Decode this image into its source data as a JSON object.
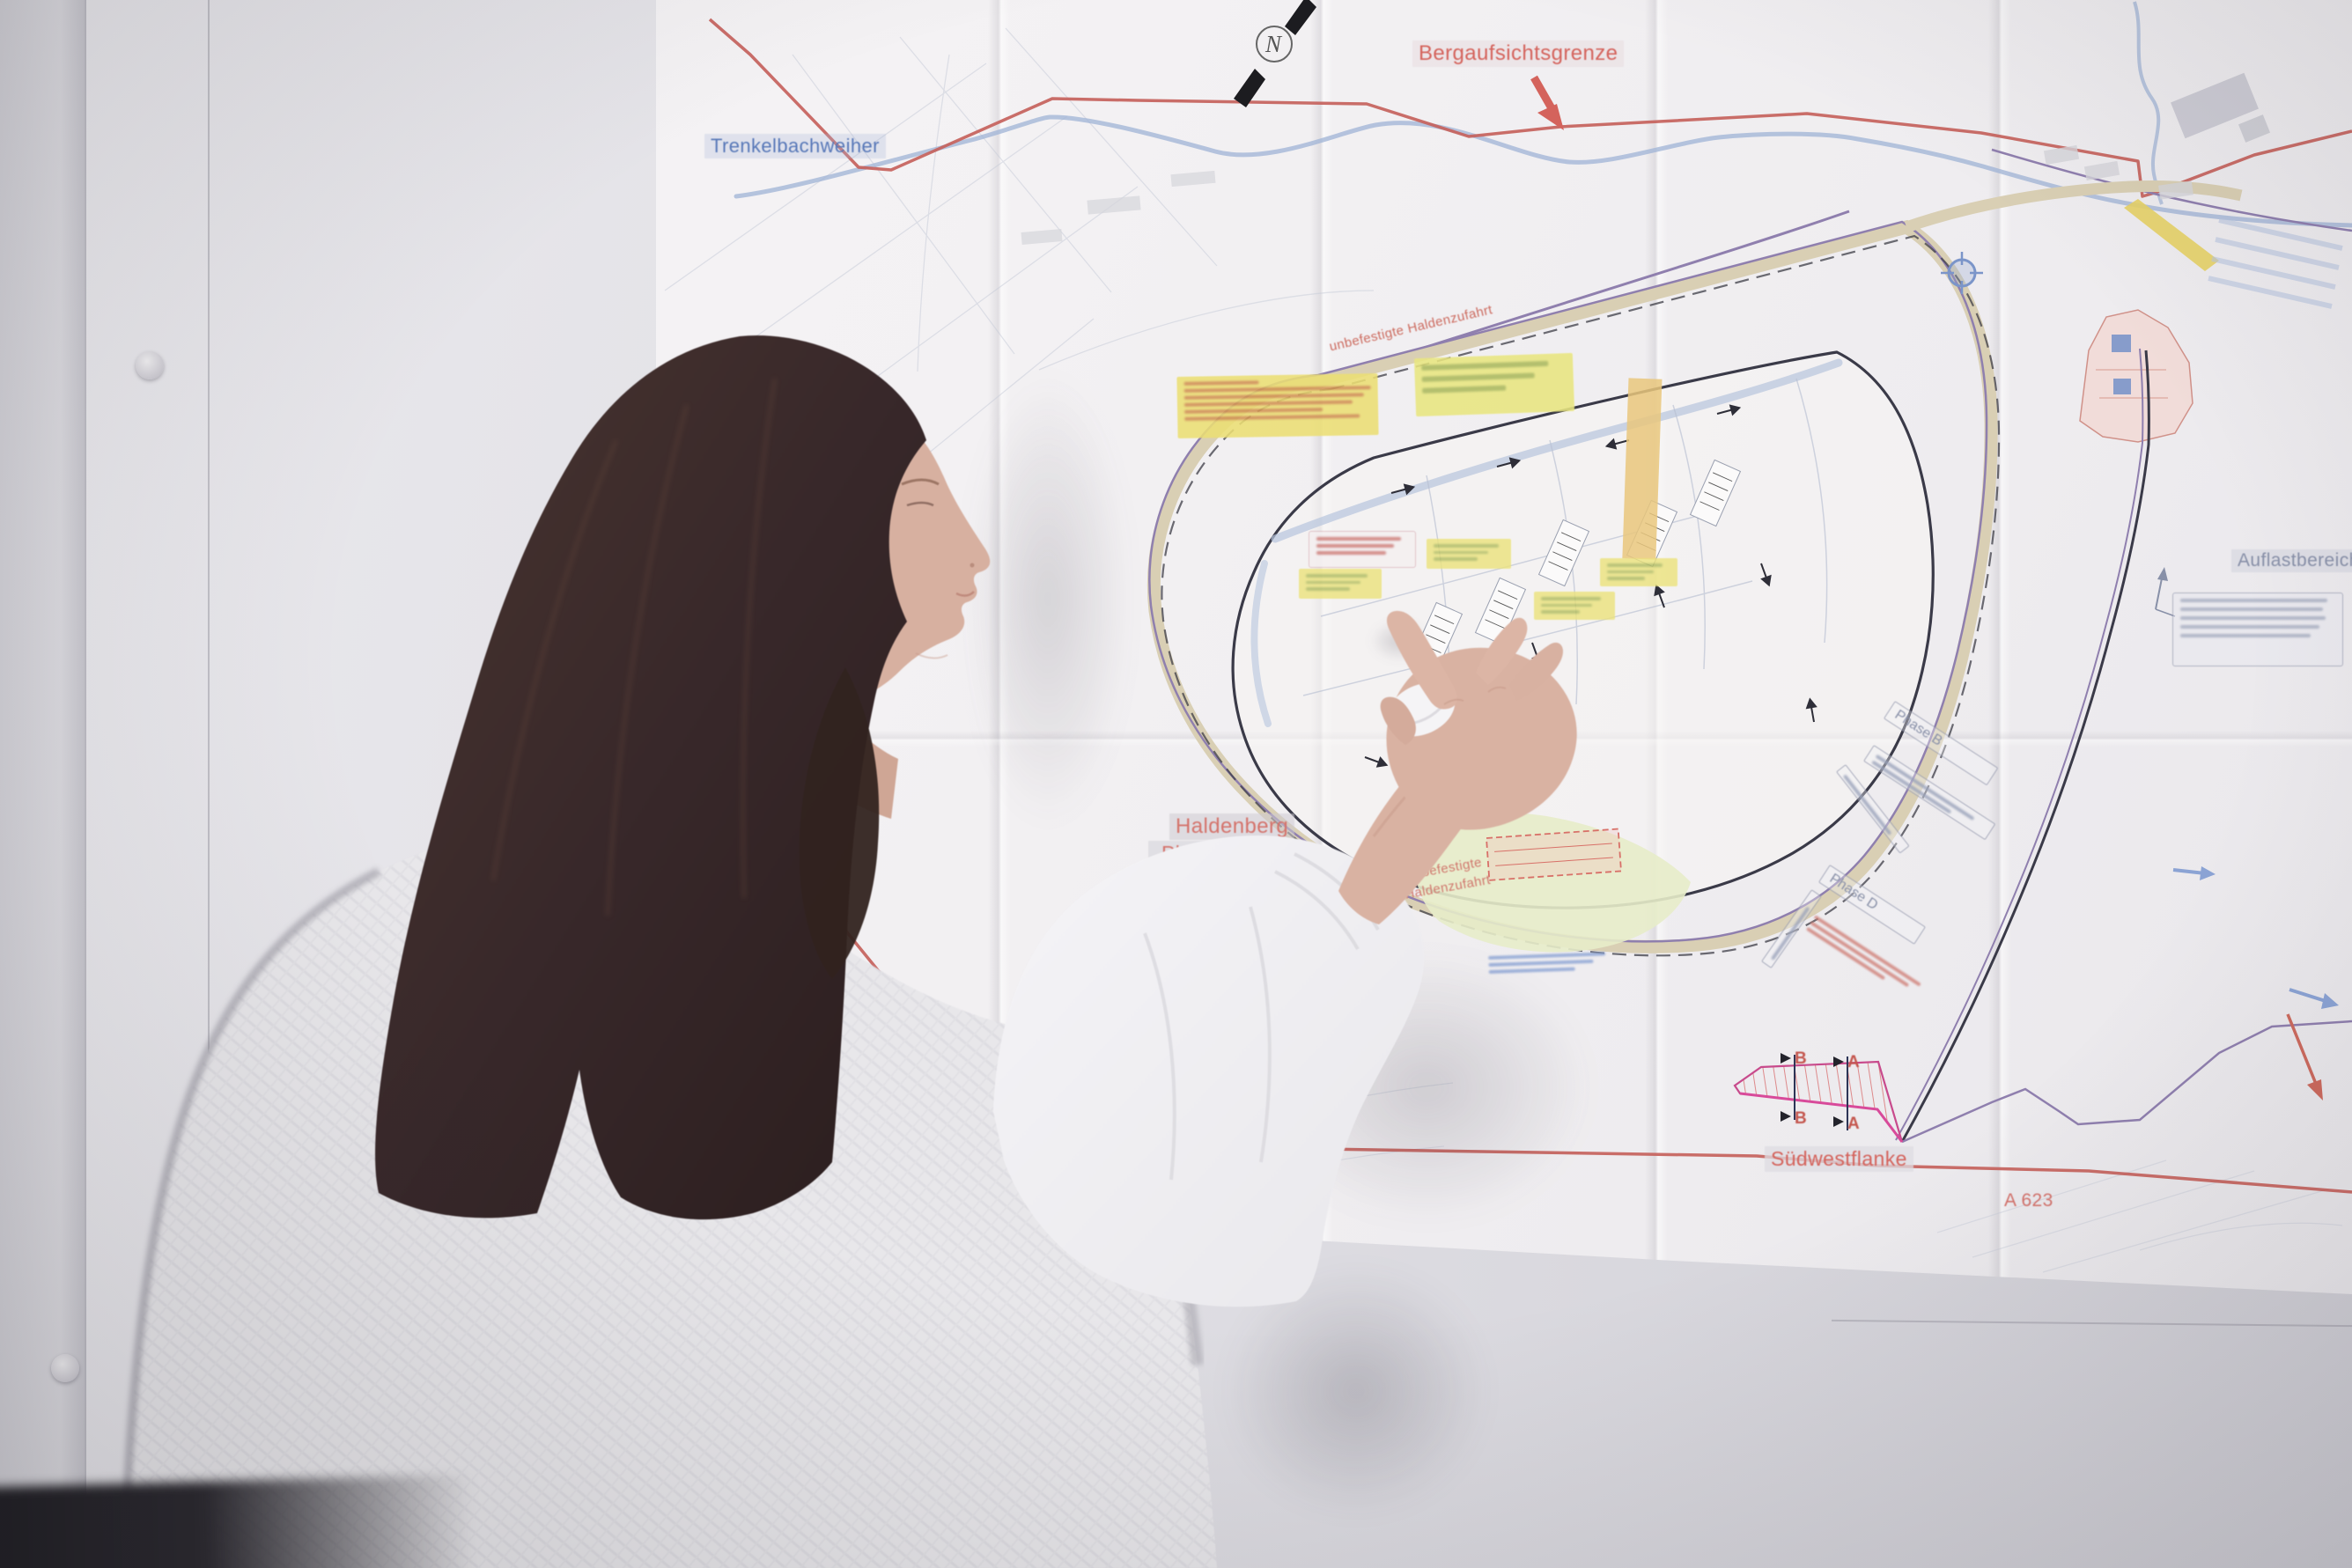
{
  "scene": {
    "description": "Frau mit langen dunkelbraunen Haaren und hellgrauem Strickpullover zeigt mit dem Finger auf einen grossen technischen Lageplan (Haldenplan), der an einer hellen Wand haengt",
    "person_action": "zeigt auf die Planungsflaeche des Plans"
  },
  "map": {
    "type": "Lageplan / Haldenplanung",
    "compass_n": "N",
    "labels": {
      "trenkelbachweiher": "Trenkelbachweiher",
      "bergaufsichtsgrenze": "Bergaufsichtsgrenze",
      "haldenberg_line1": "Haldenberg",
      "haldenberg_line2": "„Planungsfl…",
      "haldenzufahrt_diagonal": "unbefestigte Haldenzufahrt",
      "haldenzufahrt_left_line1": "unbefestigte",
      "haldenzufahrt_left_line2": "Haldenzufahrt",
      "auflastbereich": "Auflastbereich",
      "phase_b": "Phase B",
      "phase_d": "Phase D",
      "suedwestflanke": "Südwestflanke",
      "a_623": "A 623",
      "section_marker_a": "A",
      "section_marker_b": "B"
    },
    "colors": {
      "boundary_red": "#c5625c",
      "stream_blue": "#9fb3d6",
      "road_beige": "#d9cfb4",
      "boundary_purple": "#8f7fae",
      "plateau_outline": "#3a3a48",
      "note_yellow": "#ece37c",
      "note_text_green": "#9cae54",
      "note_text_orange": "#c87648",
      "section_magenta": "#d84a9a"
    },
    "sticky_notes_text_legible": false
  }
}
